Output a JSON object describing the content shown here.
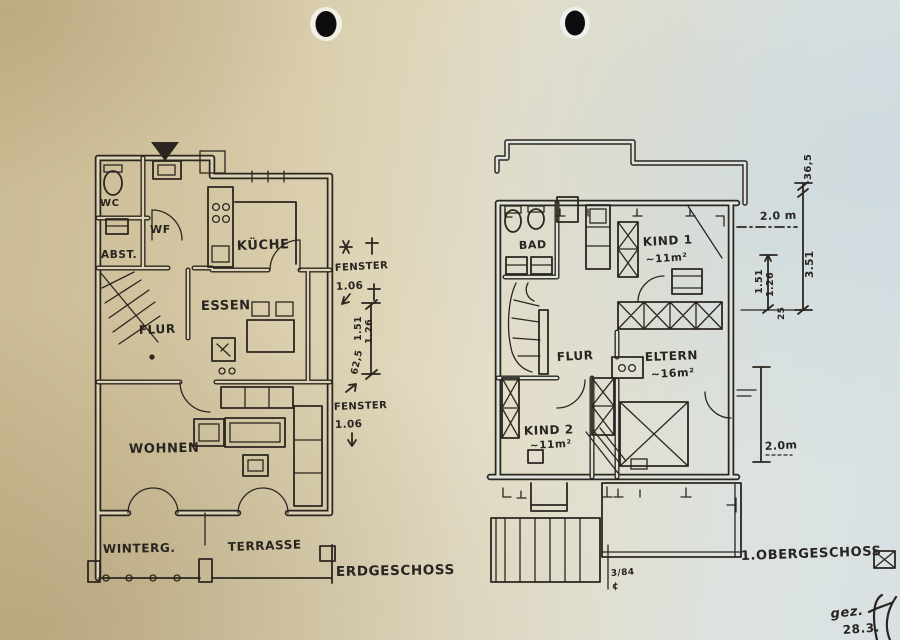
{
  "colors": {
    "ink": "#2b2620",
    "paper_left": "#d2c5a2",
    "paper_right": "#dbe2e4"
  },
  "ground_floor": {
    "title": "ERDGESCHOSS",
    "rooms": {
      "wc": "WC",
      "abst": "ABST.",
      "wf": "WF",
      "kueche": "KÜCHE",
      "essen": "ESSEN",
      "flur": "FLUR",
      "wohnen": "WOHNEN",
      "wintergarten": "WINTERG.",
      "terrasse": "TERRASSE"
    }
  },
  "upper_floor": {
    "title": "1.OBERGESCHOSS",
    "rooms": {
      "bad": "BAD",
      "kind1": "KIND 1",
      "kind1_area": "~11m²",
      "flur": "FLUR",
      "eltern": "ELTERN",
      "eltern_area": "~16m²",
      "kind2": "KIND 2",
      "kind2_area": "~11m²"
    },
    "mark": "3/84",
    "mark_symbol": "¢"
  },
  "dimensions": {
    "left": {
      "fenster_label_top": "FENSTER",
      "fenster_value_top": "1.06",
      "dim_1_51": "1.51",
      "dim_1_26": "1.26",
      "dim_62_5": "62,5",
      "fenster_label_bottom": "FENSTER",
      "fenster_value_bottom": "1.06"
    },
    "right": {
      "dim_36_5": "36,5",
      "dim_2_0_top": "2.0 m",
      "dim_3_51": "3.51",
      "dim_1_51": "1.51",
      "dim_1_26": "1.26",
      "dim_25": "25",
      "dim_2_0_side": "2.0m"
    }
  },
  "signature": {
    "gez": "gez.",
    "date": "28.3."
  }
}
